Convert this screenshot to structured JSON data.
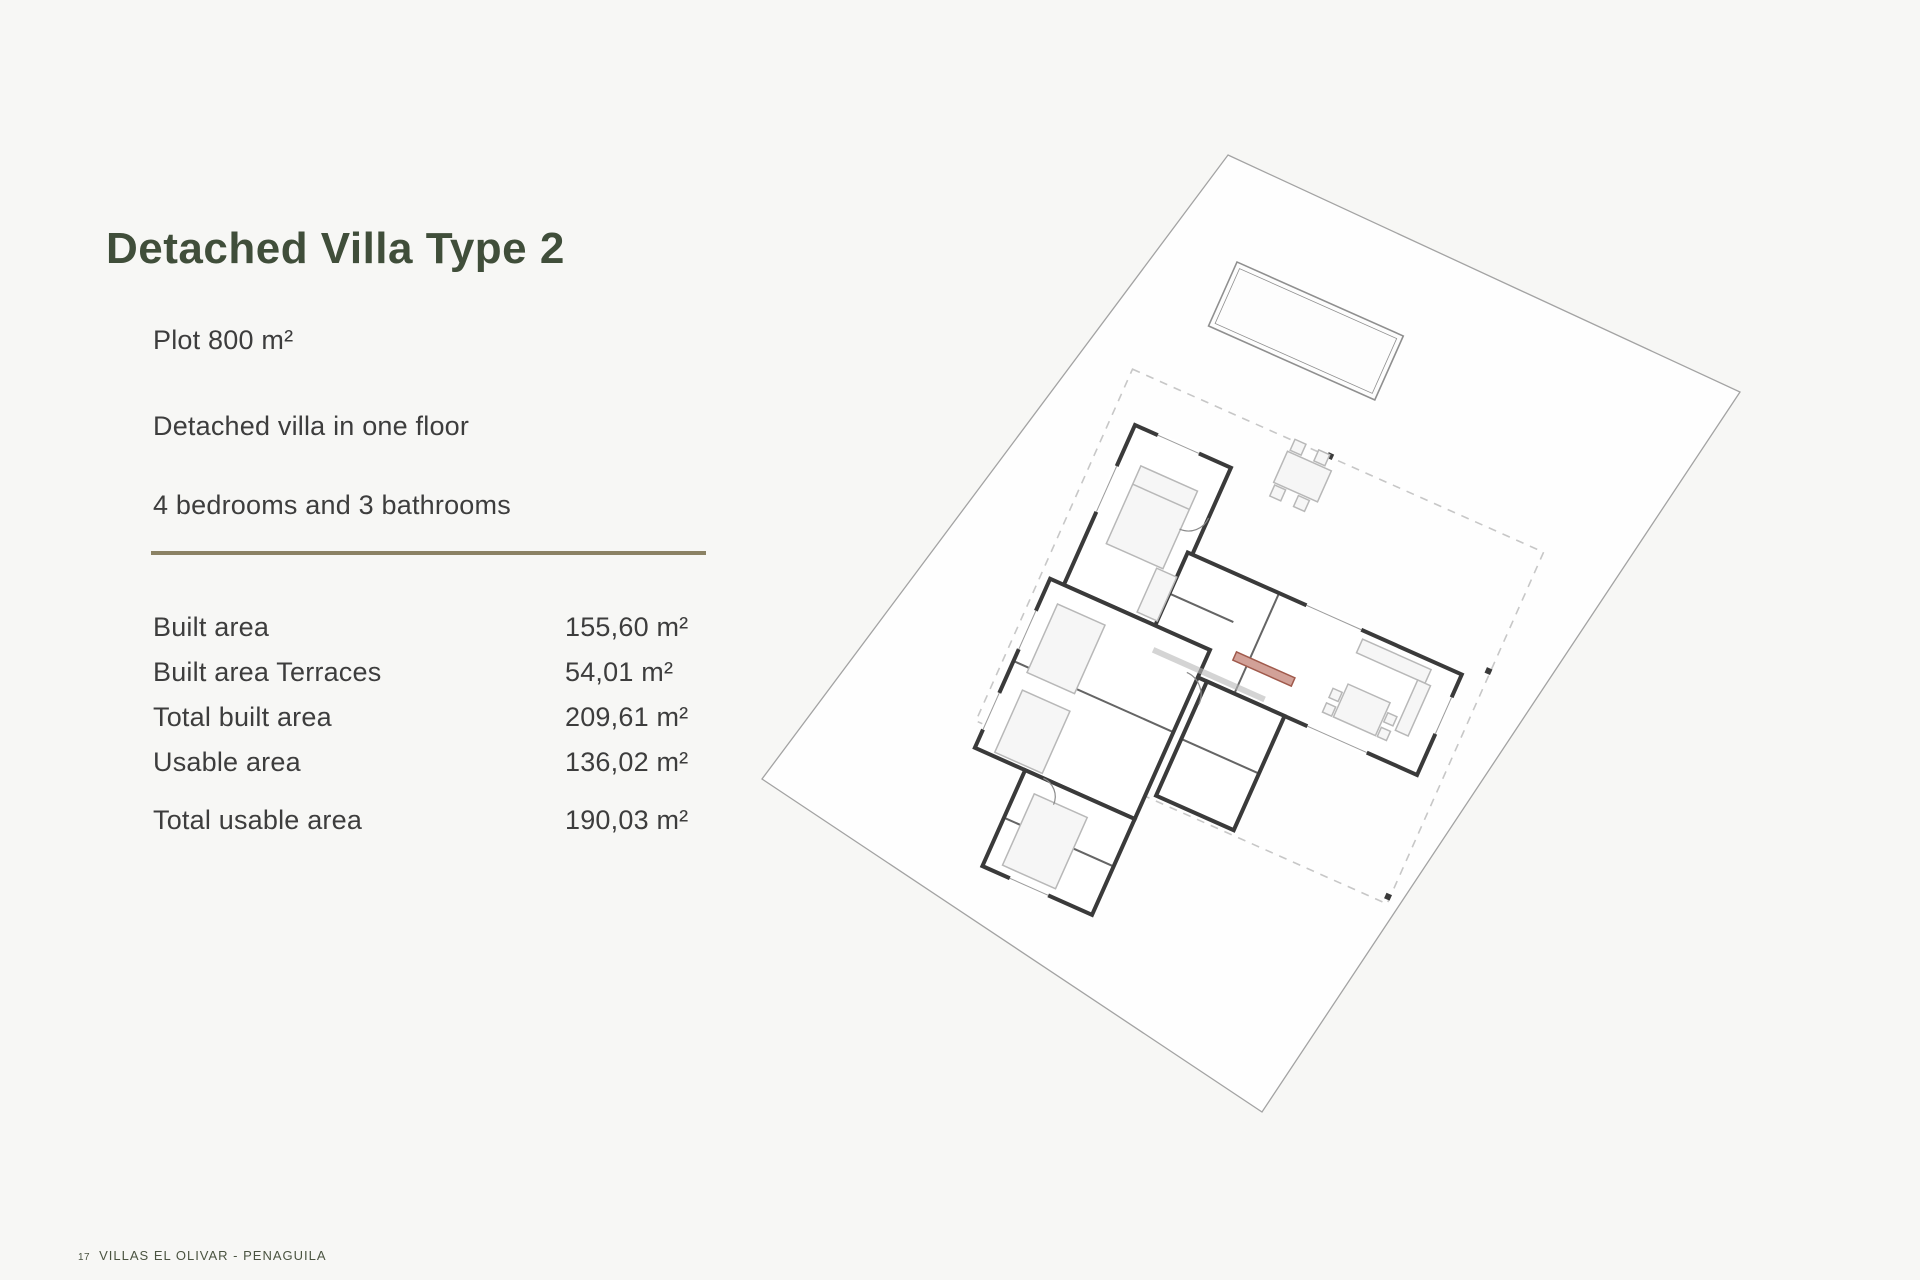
{
  "theme": {
    "bg": "#f7f7f5",
    "title-color": "#404e3a",
    "text-color": "#3d3d3d",
    "rule-color": "#8b8264",
    "footer-color": "#4a5340",
    "wall-color": "#3a3a3a",
    "furniture-color": "#b8b8b8",
    "dashed-color": "#c7c7c7",
    "accent-color": "#a05a4c",
    "plot-line-color": "#a3a3a3",
    "plot-fill": "#fefefe"
  },
  "header": {
    "title": "Detached Villa Type 2"
  },
  "intro": {
    "plot": "Plot 800 m²",
    "floors": "Detached villa in one floor",
    "rooms": "4 bedrooms and 3 bathrooms"
  },
  "areas": {
    "rows": [
      {
        "label": "Built area",
        "value": "155,60 m²"
      },
      {
        "label": "Built area Terraces",
        "value": "54,01 m²"
      },
      {
        "label": "Total built area",
        "value": "209,61 m²"
      },
      {
        "label": "Usable area",
        "value": "136,02 m²"
      }
    ],
    "total": {
      "label": "Total usable area",
      "value": "190,03 m²"
    }
  },
  "footer": {
    "page_number": "17",
    "project_name": "VILLAS EL OLIVAR - PENAGUILA"
  }
}
